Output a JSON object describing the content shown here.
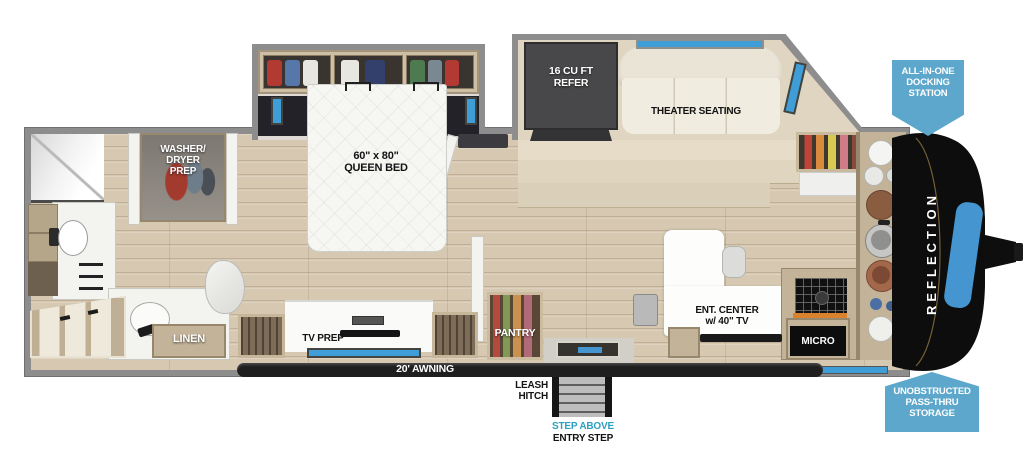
{
  "brand": {
    "name": "REFLECTION"
  },
  "badges": {
    "docking_station": "ALL-IN-ONE\nDOCKING\nSTATION",
    "pass_thru": "UNOBSTRUCTED\nPASS-THRU\nSTORAGE"
  },
  "bedroom": {
    "queen_bed": "60\" x 80\"\nQUEEN BED",
    "washer_dryer": "WASHER/\nDRYER\nPREP",
    "tv_prep": "TV PREP"
  },
  "bath": {
    "linen": "LINEN"
  },
  "kitchen": {
    "refer": "16 CU FT\nREFER",
    "pantry": "PANTRY",
    "micro": "MICRO",
    "ent_center": "ENT. CENTER\nw/ 40\" TV"
  },
  "living": {
    "theater_seating": "THEATER SEATING"
  },
  "exterior": {
    "awning": "20' AWNING",
    "leash_hitch": "LEASH\nHITCH",
    "step_above": "STEP ABOVE",
    "entry_step": "ENTRY STEP"
  },
  "colors": {
    "badge_blue": "#5ca7cb",
    "window_blue": "#3f9ed8",
    "teal_text": "#2da0c2",
    "cap_accent_blue": "#4596d0",
    "wall_gray": "#8d8d8d",
    "floor_wood": "#d6c8b1"
  }
}
